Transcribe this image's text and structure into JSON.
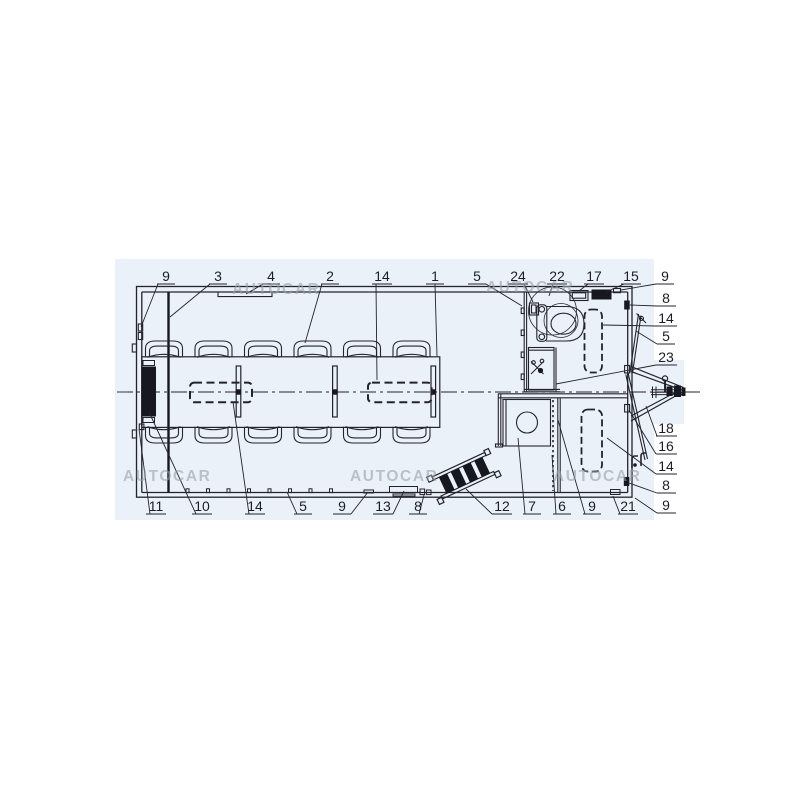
{
  "title": "trailer-floorplan-diagram",
  "watermark_text": "AUTOCAR",
  "colors": {
    "line": "#23232e",
    "panel_blue": "#ebf1f8",
    "watermark": "#97a0ab",
    "background": "#ffffff"
  },
  "watermarks": [
    {
      "x": 232,
      "y": 294
    },
    {
      "x": 486,
      "y": 292
    },
    {
      "x": 123,
      "y": 481
    },
    {
      "x": 350,
      "y": 481
    },
    {
      "x": 553,
      "y": 481
    }
  ],
  "callouts": [
    {
      "label": "9",
      "tx": 166,
      "ty": 281,
      "u": [
        157,
        284,
        175,
        284
      ],
      "l": [
        158,
        284,
        141,
        327
      ]
    },
    {
      "label": "3",
      "tx": 218,
      "ty": 281,
      "u": [
        209,
        284,
        227,
        284
      ],
      "l": [
        210,
        284,
        170,
        317
      ]
    },
    {
      "label": "4",
      "tx": 271,
      "ty": 281,
      "u": [
        262,
        284,
        280,
        284
      ],
      "l": [
        263,
        284,
        246,
        294
      ]
    },
    {
      "label": "2",
      "tx": 330,
      "ty": 281,
      "u": [
        321,
        284,
        339,
        284
      ],
      "l": [
        322,
        284,
        305,
        343
      ]
    },
    {
      "label": "14",
      "tx": 382,
      "ty": 281,
      "u": [
        372,
        284,
        392,
        284
      ],
      "l": [
        376,
        284,
        377,
        380
      ]
    },
    {
      "label": "1",
      "tx": 435,
      "ty": 281,
      "u": [
        426,
        284,
        444,
        284
      ],
      "l": [
        435,
        284,
        437,
        356
      ]
    },
    {
      "label": "5",
      "tx": 477,
      "ty": 281,
      "u": [
        468,
        284,
        486,
        284
      ],
      "l": [
        486,
        284,
        522,
        306
      ]
    },
    {
      "label": "24",
      "tx": 518,
      "ty": 281,
      "u": [
        508,
        284,
        528,
        284
      ],
      "l": [
        524,
        284,
        533,
        302
      ]
    },
    {
      "label": "22",
      "tx": 557,
      "ty": 281,
      "u": [
        547,
        284,
        567,
        284
      ],
      "l": [
        553,
        284,
        549,
        296
      ]
    },
    {
      "label": "17",
      "tx": 594,
      "ty": 281,
      "u": [
        584,
        284,
        604,
        284
      ],
      "l": [
        588,
        284,
        579,
        291
      ]
    },
    {
      "label": "15",
      "tx": 631,
      "ty": 281,
      "u": [
        621,
        284,
        641,
        284
      ],
      "l": [
        624,
        284,
        606,
        292
      ]
    },
    {
      "label": "9",
      "tx": 665,
      "ty": 281,
      "u": [
        656,
        284,
        674,
        284
      ],
      "l": [
        656,
        284,
        621,
        290
      ]
    },
    {
      "label": "8",
      "tx": 666,
      "ty": 303,
      "u": [
        657,
        306,
        676,
        306
      ],
      "l": [
        657,
        306,
        630,
        305
      ]
    },
    {
      "label": "14",
      "tx": 666,
      "ty": 323,
      "u": [
        656,
        326,
        677,
        326
      ],
      "l": [
        656,
        326,
        603,
        325
      ]
    },
    {
      "label": "5",
      "tx": 666,
      "ty": 341,
      "u": [
        657,
        344,
        675,
        344
      ],
      "l": [
        657,
        344,
        636,
        331
      ]
    },
    {
      "label": "23",
      "tx": 666,
      "ty": 362,
      "u": [
        656,
        365,
        677,
        365
      ],
      "l": [
        656,
        365,
        556,
        384
      ]
    },
    {
      "label": "18",
      "tx": 666,
      "ty": 433,
      "u": [
        656,
        436,
        677,
        436
      ],
      "l": [
        657,
        436,
        646,
        406
      ]
    },
    {
      "label": "16",
      "tx": 666,
      "ty": 451,
      "u": [
        656,
        454,
        677,
        454
      ],
      "l": [
        656,
        454,
        629,
        410
      ]
    },
    {
      "label": "14",
      "tx": 666,
      "ty": 471,
      "u": [
        656,
        474,
        677,
        474
      ],
      "l": [
        656,
        474,
        607,
        438
      ]
    },
    {
      "label": "8",
      "tx": 666,
      "ty": 490,
      "u": [
        657,
        493,
        676,
        493
      ],
      "l": [
        657,
        493,
        629,
        483
      ]
    },
    {
      "label": "9",
      "tx": 666,
      "ty": 510,
      "u": [
        657,
        513,
        676,
        513
      ],
      "l": [
        657,
        513,
        635,
        498
      ]
    },
    {
      "label": "11",
      "tx": 156,
      "ty": 511,
      "u": [
        146,
        514,
        166,
        514
      ],
      "l": [
        150,
        514,
        139,
        429
      ]
    },
    {
      "label": "10",
      "tx": 202,
      "ty": 511,
      "u": [
        192,
        514,
        212,
        514
      ],
      "l": [
        196,
        514,
        149,
        412
      ]
    },
    {
      "label": "14",
      "tx": 255,
      "ty": 511,
      "u": [
        245,
        514,
        265,
        514
      ],
      "l": [
        249,
        514,
        233,
        402
      ]
    },
    {
      "label": "5",
      "tx": 303,
      "ty": 511,
      "u": [
        294,
        514,
        312,
        514
      ],
      "l": [
        297,
        514,
        287,
        492
      ]
    },
    {
      "label": "9",
      "tx": 342,
      "ty": 511,
      "u": [
        333,
        514,
        351,
        514
      ],
      "l": [
        351,
        514,
        368,
        492
      ]
    },
    {
      "label": "13",
      "tx": 383,
      "ty": 511,
      "u": [
        373,
        514,
        393,
        514
      ],
      "l": [
        393,
        514,
        404,
        491
      ]
    },
    {
      "label": "8",
      "tx": 418,
      "ty": 511,
      "u": [
        409,
        514,
        427,
        514
      ],
      "l": [
        419,
        514,
        424,
        495
      ]
    },
    {
      "label": "12",
      "tx": 502,
      "ty": 511,
      "u": [
        492,
        514,
        512,
        514
      ],
      "l": [
        492,
        514,
        466,
        489
      ]
    },
    {
      "label": "7",
      "tx": 532,
      "ty": 511,
      "u": [
        523,
        514,
        541,
        514
      ],
      "l": [
        525,
        514,
        518,
        438
      ]
    },
    {
      "label": "6",
      "tx": 562,
      "ty": 511,
      "u": [
        553,
        514,
        571,
        514
      ],
      "l": [
        556,
        514,
        552,
        455
      ]
    },
    {
      "label": "9",
      "tx": 592,
      "ty": 511,
      "u": [
        583,
        514,
        601,
        514
      ],
      "l": [
        585,
        514,
        558,
        420
      ]
    },
    {
      "label": "21",
      "tx": 628,
      "ty": 511,
      "u": [
        618,
        514,
        638,
        514
      ],
      "l": [
        620,
        514,
        613,
        496
      ]
    }
  ]
}
